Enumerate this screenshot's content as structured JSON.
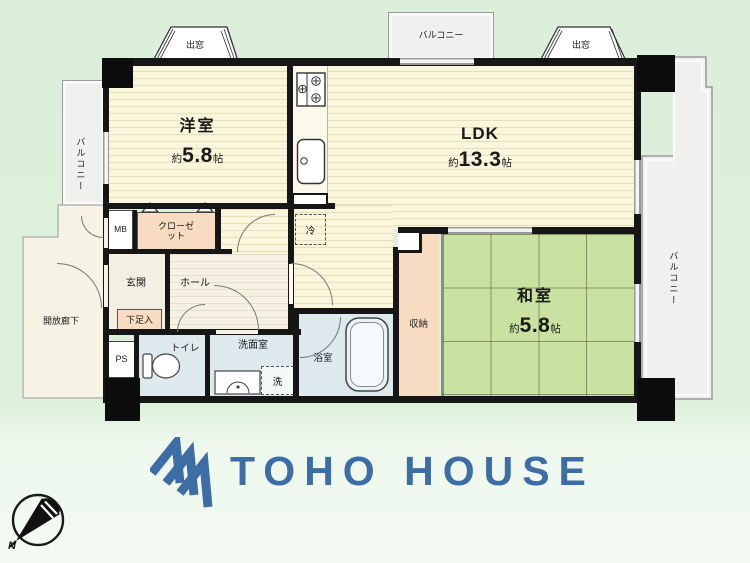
{
  "palette": {
    "wall": "#161616",
    "flooring_cream": "#faf6dc",
    "tatami_green": "#c9e2a1",
    "closet_peach": "#f8dcc1",
    "wet_area_blue": "#dde9ed",
    "balcony_gray": "#f0f0ee",
    "background_green": "#ddefdb",
    "logo_blue": "#3e6da5"
  },
  "plan": {
    "bay_windows": {
      "top_left": "出窓",
      "top_right": "出窓"
    },
    "balconies": {
      "top": "バルコニー",
      "left": "バルコニー",
      "right": "バルコニー"
    },
    "rooms": {
      "western": {
        "label": "洋室",
        "size_prefix": "約",
        "size_value": "5.8",
        "size_unit": "帖"
      },
      "ldk": {
        "label": "LDK",
        "size_prefix": "約",
        "size_value": "13.3",
        "size_unit": "帖"
      },
      "japanese": {
        "label": "和室",
        "size_prefix": "約",
        "size_value": "5.8",
        "size_unit": "帖"
      },
      "entrance": {
        "label": "玄関"
      },
      "hall": {
        "label": "ホール"
      },
      "toilet": {
        "label": "トイレ"
      },
      "washroom": {
        "label": "洗面室"
      },
      "bathroom": {
        "label": "浴室"
      },
      "storage": {
        "label": "収納"
      },
      "closet": {
        "label": "クローゼット"
      },
      "shoe_cabinet": {
        "label": "下足入"
      },
      "open_corridor": {
        "label": "開放廊下"
      },
      "meter_box": {
        "label": "MB"
      },
      "pipe_space": {
        "label": "PS"
      },
      "refrigerator": {
        "label": "冷"
      },
      "washing_machine": {
        "label": "洗"
      }
    }
  },
  "compass": {
    "north_label": "N"
  },
  "logo": {
    "text": "TOHO HOUSE"
  }
}
